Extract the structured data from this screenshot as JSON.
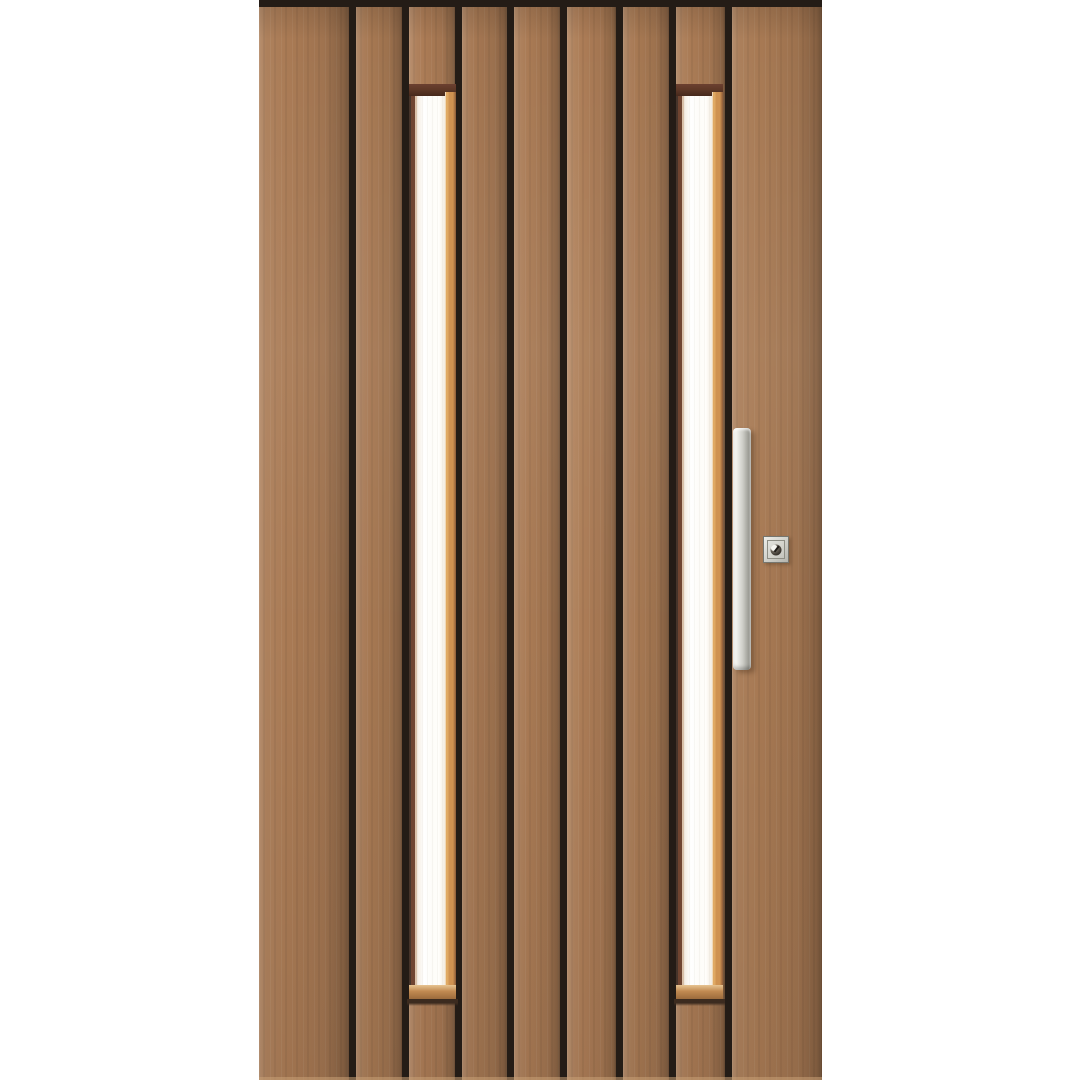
{
  "scene": {
    "type": "product-render",
    "subject": "Modern timber front entry door with vertical plank cladding, two narrow full-height glazing strips, vertical pull handle and square key lock, on plain white background",
    "background_color": "#ffffff",
    "canvas": {
      "width": 1080,
      "height": 1080
    }
  },
  "door": {
    "x": 259,
    "y": 0,
    "width": 563,
    "height": 1080,
    "top_band_height": 7,
    "plank_count": 9,
    "window_count": 2,
    "planks": [
      {
        "left": 0,
        "width": 90,
        "tone": 1.0
      },
      {
        "left": 97,
        "width": 46,
        "tone": 0.98
      },
      {
        "left": 150,
        "width": 46,
        "tone": 1.01
      },
      {
        "left": 203,
        "width": 45,
        "tone": 0.97
      },
      {
        "left": 255,
        "width": 46,
        "tone": 1.0
      },
      {
        "left": 308,
        "width": 49,
        "tone": 1.02
      },
      {
        "left": 364,
        "width": 46,
        "tone": 0.98
      },
      {
        "left": 417,
        "width": 49,
        "tone": 1.0
      },
      {
        "left": 473,
        "width": 90,
        "tone": 0.99
      }
    ],
    "windows": [
      {
        "left": 150,
        "width": 47,
        "frame_top_y": 84,
        "glass_top": 96,
        "glass_bottom": 985,
        "glass_inset_left": 8,
        "glass_inset_right": 11,
        "sill_height": 14,
        "sill_shadow_height": 7
      },
      {
        "left": 417,
        "width": 47,
        "frame_top_y": 84,
        "glass_top": 96,
        "glass_bottom": 985,
        "glass_inset_left": 8,
        "glass_inset_right": 11,
        "sill_height": 14,
        "sill_shadow_height": 7
      }
    ],
    "hardware": {
      "handle": {
        "left": 474,
        "top": 428,
        "width": 18,
        "height": 242,
        "radius": 4
      },
      "lock": {
        "left": 504,
        "top": 536,
        "width": 26,
        "height": 27,
        "keyhole_diameter": 11
      }
    },
    "colors": {
      "scene_bg": "#ffffff",
      "plank": "#a97a54",
      "groove": "#241c16",
      "glass": "#fdfcf8",
      "glass_tint": "#f3ebdf",
      "frame_top": "#5e3827",
      "frame_left": "#6f4430",
      "frame_left_edge": "#d9c0a8",
      "frame_right": "#cf9251",
      "frame_right_edge": "#8a5a38",
      "sill": "#c18a51",
      "sill_shadow": "#3c2b1f",
      "handle_light": "#f2f2ee",
      "handle_mid": "#cdcdc7",
      "handle_dark": "#9e9e97",
      "handle_shadow": "rgba(62,40,20,0.35)",
      "lock_border": "#76766f",
      "lock_face_light": "#eeeee9",
      "lock_face_dark": "#b4b4ad",
      "keyhole": "#3b3630"
    }
  }
}
